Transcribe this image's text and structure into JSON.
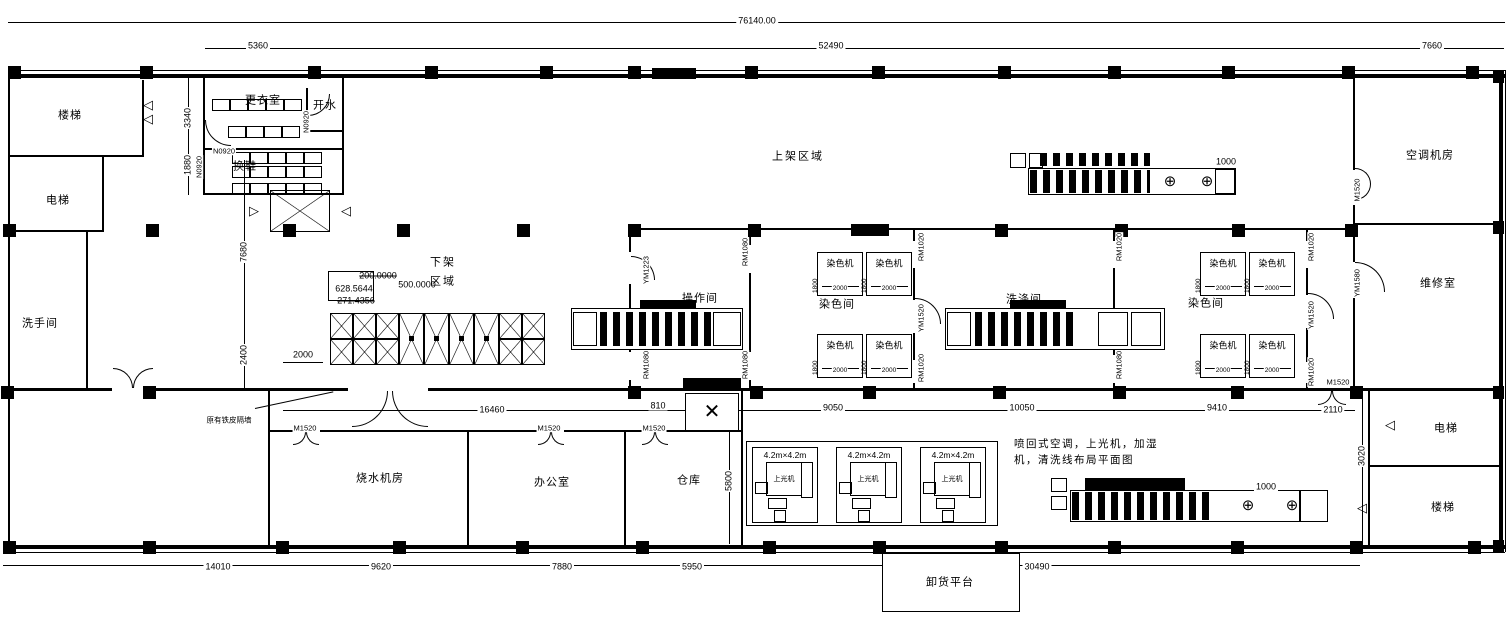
{
  "areas": {
    "upper": "上架区域",
    "lower_line1": "下架",
    "lower_line2": "区域"
  },
  "note": {
    "line1": "喷回式空调，上光机，加湿",
    "line2": "机，清洗线布局平面图"
  },
  "annotation": "原有铁皮隔墙",
  "room_labels": [
    {
      "name": "room-stairs-top-left",
      "text": "楼梯",
      "x": 70,
      "y": 116
    },
    {
      "name": "room-elevator-left",
      "text": "电梯",
      "x": 58,
      "y": 201
    },
    {
      "name": "room-washroom",
      "text": "洗手间",
      "x": 40,
      "y": 324
    },
    {
      "name": "room-changing",
      "text": "更衣室",
      "x": 263,
      "y": 101
    },
    {
      "name": "room-shoe-change",
      "text": "换鞋",
      "x": 245,
      "y": 167
    },
    {
      "name": "room-hot-water",
      "text": "开水",
      "x": 325,
      "y": 106
    },
    {
      "name": "room-operation",
      "text": "操作间",
      "x": 700,
      "y": 299
    },
    {
      "name": "room-dye-1",
      "text": "染色间",
      "x": 837,
      "y": 305
    },
    {
      "name": "room-washing",
      "text": "洗涤间",
      "x": 1024,
      "y": 300
    },
    {
      "name": "room-dye-2",
      "text": "染色间",
      "x": 1206,
      "y": 304
    },
    {
      "name": "room-ac",
      "text": "空调机房",
      "x": 1430,
      "y": 156
    },
    {
      "name": "room-maintenance",
      "text": "维修室",
      "x": 1438,
      "y": 284
    },
    {
      "name": "room-boiler",
      "text": "烧水机房",
      "x": 380,
      "y": 479
    },
    {
      "name": "room-office",
      "text": "办公室",
      "x": 552,
      "y": 483
    },
    {
      "name": "room-warehouse",
      "text": "仓库",
      "x": 689,
      "y": 481
    },
    {
      "name": "room-elevator-right",
      "text": "电梯",
      "x": 1446,
      "y": 429
    },
    {
      "name": "room-stairs-right",
      "text": "楼梯",
      "x": 1443,
      "y": 508
    },
    {
      "name": "platform-unload",
      "text": "卸货平台",
      "x": 950,
      "y": 583
    }
  ],
  "dim_labels": [
    {
      "name": "dim-total-width",
      "text": "76140.00",
      "x": 757,
      "y": 21
    },
    {
      "name": "dim-5360",
      "text": "5360",
      "x": 258,
      "y": 46
    },
    {
      "name": "dim-52490",
      "text": "52490",
      "x": 831,
      "y": 46
    },
    {
      "name": "dim-7660",
      "text": "7660",
      "x": 1432,
      "y": 46
    },
    {
      "name": "dim-3340",
      "text": "3340",
      "x": 188,
      "y": 118,
      "v": true
    },
    {
      "name": "dim-1880",
      "text": "1880",
      "x": 188,
      "y": 165,
      "v": true
    },
    {
      "name": "dim-7680",
      "text": "7680",
      "x": 244,
      "y": 252,
      "v": true
    },
    {
      "name": "dim-2400",
      "text": "2400",
      "x": 244,
      "y": 355,
      "v": true
    },
    {
      "name": "dim-2000",
      "text": "2000",
      "x": 303,
      "y": 355
    },
    {
      "name": "dim-16460",
      "text": "16460",
      "x": 492,
      "y": 410
    },
    {
      "name": "dim-810",
      "text": "810",
      "x": 658,
      "y": 406
    },
    {
      "name": "dim-9050",
      "text": "9050",
      "x": 833,
      "y": 408
    },
    {
      "name": "dim-10050",
      "text": "10050",
      "x": 1022,
      "y": 408
    },
    {
      "name": "dim-9410",
      "text": "9410",
      "x": 1217,
      "y": 408
    },
    {
      "name": "dim-2110",
      "text": "2110",
      "x": 1333,
      "y": 410
    },
    {
      "name": "dim-5800",
      "text": "5800",
      "x": 729,
      "y": 481,
      "v": true
    },
    {
      "name": "dim-3020",
      "text": "3020",
      "x": 1362,
      "y": 456,
      "v": true
    },
    {
      "name": "dim-14010",
      "text": "14010",
      "x": 218,
      "y": 567
    },
    {
      "name": "dim-9620",
      "text": "9620",
      "x": 381,
      "y": 567
    },
    {
      "name": "dim-7880",
      "text": "7880",
      "x": 562,
      "y": 567
    },
    {
      "name": "dim-5950",
      "text": "5950",
      "x": 692,
      "y": 567
    },
    {
      "name": "dim-30490",
      "text": "30490",
      "x": 1037,
      "y": 567
    },
    {
      "name": "dim-1000-top",
      "text": "1000",
      "x": 1226,
      "y": 162
    },
    {
      "name": "dim-1000-bottom",
      "text": "1000",
      "x": 1266,
      "y": 487
    }
  ],
  "door_labels": [
    {
      "name": "door-n0920-a",
      "text": "N0920",
      "x": 224,
      "y": 151
    },
    {
      "name": "door-n0920-b",
      "text": "N0920",
      "x": 199,
      "y": 167,
      "v": true
    },
    {
      "name": "door-n0920-c",
      "text": "N0920",
      "x": 306,
      "y": 122,
      "v": true
    },
    {
      "name": "door-ym1223",
      "text": "YM1223",
      "x": 646,
      "y": 270,
      "v": true
    },
    {
      "name": "door-rm1080-a",
      "text": "RM1080",
      "x": 745,
      "y": 252,
      "v": true
    },
    {
      "name": "door-rm1080-b",
      "text": "RM1080",
      "x": 646,
      "y": 365,
      "v": true
    },
    {
      "name": "door-rm1080-c",
      "text": "RM1080",
      "x": 745,
      "y": 365,
      "v": true
    },
    {
      "name": "door-rm1020-a",
      "text": "RM1020",
      "x": 921,
      "y": 247,
      "v": true
    },
    {
      "name": "door-ym1520-a",
      "text": "YM1520",
      "x": 921,
      "y": 318,
      "v": true
    },
    {
      "name": "door-rm1020-e",
      "text": "RM1020",
      "x": 921,
      "y": 368,
      "v": true
    },
    {
      "name": "door-rm1020-b",
      "text": "RM1020",
      "x": 1119,
      "y": 247,
      "v": true
    },
    {
      "name": "door-rm1080-d",
      "text": "RM1080",
      "x": 1119,
      "y": 365,
      "v": true
    },
    {
      "name": "door-rm1020-c",
      "text": "RM1020",
      "x": 1311,
      "y": 247,
      "v": true
    },
    {
      "name": "door-ym1520-b",
      "text": "YM1520",
      "x": 1311,
      "y": 315,
      "v": true
    },
    {
      "name": "door-rm1020-d",
      "text": "RM1020",
      "x": 1311,
      "y": 372,
      "v": true
    },
    {
      "name": "door-m1520-a",
      "text": "M1520",
      "x": 305,
      "y": 428
    },
    {
      "name": "door-m1520-b",
      "text": "M1520",
      "x": 549,
      "y": 428
    },
    {
      "name": "door-m1520-c",
      "text": "M1520",
      "x": 654,
      "y": 428
    },
    {
      "name": "door-m1520-d",
      "text": "M1520",
      "x": 1338,
      "y": 382
    },
    {
      "name": "door-m1520-e",
      "text": "M1520",
      "x": 1357,
      "y": 190,
      "v": true
    },
    {
      "name": "door-ym1580",
      "text": "YM1580",
      "x": 1357,
      "y": 283,
      "v": true
    }
  ],
  "calc_labels": [
    {
      "name": "calc-200",
      "text": "200.0000",
      "x": 378,
      "y": 276,
      "strike": true
    },
    {
      "name": "calc-628",
      "text": "628.5644",
      "x": 354,
      "y": 289
    },
    {
      "name": "calc-500",
      "text": "500.0000",
      "x": 417,
      "y": 285
    },
    {
      "name": "calc-271",
      "text": "271.4356",
      "x": 356,
      "y": 301,
      "strike": true
    }
  ],
  "dye_machine": {
    "label": "染色机",
    "width_label": "2000",
    "height_label": "1800",
    "positions": [
      [
        817,
        252
      ],
      [
        866,
        252
      ],
      [
        817,
        334
      ],
      [
        866,
        334
      ],
      [
        1200,
        252
      ],
      [
        1249,
        252
      ],
      [
        1200,
        334
      ],
      [
        1249,
        334
      ]
    ]
  },
  "platform_area": {
    "size_label": "4.2m×4.2m",
    "machine_label": "上光机",
    "boxes_x": [
      752,
      836,
      920
    ],
    "y": 447
  }
}
